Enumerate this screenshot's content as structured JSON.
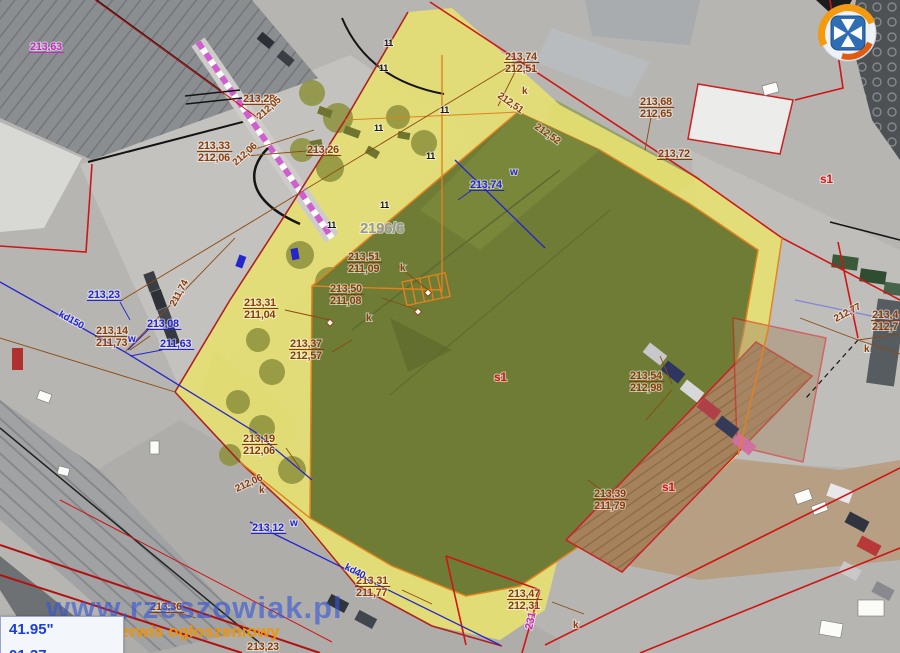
{
  "title": "aerial-cadastral-map",
  "watermark": {
    "line1": "www.rzeszowiak.pl",
    "line2": "rzeszowski serwis ogłoszeniowy"
  },
  "coords": {
    "line1": "41.95\"",
    "line2": "01.37"
  },
  "parcel_number": "2196/6",
  "colors": {
    "survey": "#8a3c08",
    "water": "#2525cf",
    "red": "#e01010",
    "magenta": "#c42ac4",
    "gray": "#97998a",
    "black": "#151515"
  },
  "map_annotations": [
    {
      "x": 505,
      "y": 60,
      "c": "survey",
      "lines": [
        "213,74",
        "212,51"
      ]
    },
    {
      "x": 640,
      "y": 105,
      "c": "survey",
      "lines": [
        "213,68",
        "212,65"
      ]
    },
    {
      "x": 348,
      "y": 260,
      "c": "survey",
      "lines": [
        "213,51",
        "211,09"
      ]
    },
    {
      "x": 330,
      "y": 292,
      "c": "survey",
      "lines": [
        "213,50",
        "211,08"
      ]
    },
    {
      "x": 244,
      "y": 306,
      "c": "survey",
      "lines": [
        "213,31",
        "211,04"
      ]
    },
    {
      "x": 290,
      "y": 347,
      "c": "survey",
      "lines": [
        "213,37",
        "212,57"
      ]
    },
    {
      "x": 96,
      "y": 334,
      "c": "survey",
      "lines": [
        "213,14",
        "211,73"
      ]
    },
    {
      "x": 243,
      "y": 442,
      "c": "survey",
      "lines": [
        "213,19",
        "212,06"
      ]
    },
    {
      "x": 356,
      "y": 584,
      "c": "survey",
      "lines": [
        "213,31",
        "211,77"
      ]
    },
    {
      "x": 508,
      "y": 597,
      "c": "survey",
      "lines": [
        "213,47",
        "212,31"
      ]
    },
    {
      "x": 594,
      "y": 497,
      "c": "survey",
      "lines": [
        "213,39",
        "211,79"
      ]
    },
    {
      "x": 630,
      "y": 379,
      "c": "survey",
      "lines": [
        "213,54",
        "212,98"
      ]
    },
    {
      "x": 198,
      "y": 149,
      "c": "survey",
      "lines": [
        "213,33",
        "212,06"
      ]
    },
    {
      "x": 872,
      "y": 318,
      "c": "survey",
      "lines": [
        "213,4",
        "212,7"
      ]
    },
    {
      "x": 243,
      "y": 102,
      "c": "survey",
      "ul": true,
      "lines": [
        "213,28"
      ]
    },
    {
      "x": 307,
      "y": 153,
      "c": "survey",
      "ul": true,
      "lines": [
        "213,26"
      ]
    },
    {
      "x": 658,
      "y": 157,
      "c": "survey",
      "ul": true,
      "lines": [
        "213,72"
      ]
    },
    {
      "x": 150,
      "y": 610,
      "c": "survey",
      "ul": true,
      "lines": [
        "213,36"
      ]
    },
    {
      "x": 247,
      "y": 650,
      "c": "survey",
      "lines": [
        "213,23"
      ]
    },
    {
      "x": 88,
      "y": 298,
      "c": "water",
      "ul": true,
      "lines": [
        "213,23"
      ]
    },
    {
      "x": 147,
      "y": 327,
      "c": "water",
      "ul": true,
      "lines": [
        "213,08"
      ]
    },
    {
      "x": 160,
      "y": 347,
      "c": "water",
      "ul": true,
      "lines": [
        "211,63"
      ]
    },
    {
      "x": 470,
      "y": 188,
      "c": "water",
      "ul": true,
      "lines": [
        "213,74"
      ]
    },
    {
      "x": 252,
      "y": 531,
      "c": "water",
      "ul": true,
      "lines": [
        "213,12"
      ]
    },
    {
      "x": 30,
      "y": 50,
      "c": "magenta",
      "ul": true,
      "lines": [
        "213,63"
      ]
    },
    {
      "x": 360,
      "y": 233,
      "c": "gray",
      "fs": 15,
      "lines": [
        "2196/6"
      ]
    },
    {
      "x": 494,
      "y": 381,
      "c": "red",
      "fs": 12,
      "lines": [
        "s1"
      ]
    },
    {
      "x": 662,
      "y": 491,
      "c": "red",
      "fs": 12,
      "lines": [
        "s1"
      ]
    },
    {
      "x": 820,
      "y": 183,
      "c": "red",
      "fs": 12,
      "lines": [
        "s1"
      ]
    },
    {
      "x": 400,
      "y": 271,
      "c": "survey",
      "fs": 10,
      "lines": [
        "k"
      ]
    },
    {
      "x": 366,
      "y": 321,
      "c": "survey",
      "fs": 10,
      "lines": [
        "k"
      ]
    },
    {
      "x": 522,
      "y": 94,
      "c": "survey",
      "fs": 10,
      "lines": [
        "k"
      ]
    },
    {
      "x": 259,
      "y": 493,
      "c": "survey",
      "fs": 10,
      "lines": [
        "k"
      ]
    },
    {
      "x": 573,
      "y": 628,
      "c": "survey",
      "fs": 10,
      "lines": [
        "k"
      ]
    },
    {
      "x": 864,
      "y": 352,
      "c": "survey",
      "fs": 10,
      "lines": [
        "k"
      ]
    },
    {
      "x": 510,
      "y": 175,
      "c": "water",
      "fs": 10,
      "lines": [
        "w"
      ]
    },
    {
      "x": 128,
      "y": 342,
      "c": "water",
      "fs": 10,
      "lines": [
        "w"
      ]
    },
    {
      "x": 290,
      "y": 526,
      "c": "water",
      "fs": 10,
      "lines": [
        "w"
      ]
    },
    {
      "x": 497,
      "y": 97,
      "c": "survey",
      "fs": 10,
      "rot": 35,
      "lines": [
        "212,51"
      ]
    },
    {
      "x": 534,
      "y": 128,
      "c": "survey",
      "fs": 10,
      "rot": 35,
      "lines": [
        "212,52"
      ]
    },
    {
      "x": 175,
      "y": 307,
      "c": "survey",
      "fs": 10,
      "rot": -62,
      "lines": [
        "211,74"
      ]
    },
    {
      "x": 260,
      "y": 120,
      "c": "survey",
      "fs": 10,
      "rot": -42,
      "lines": [
        "212,05"
      ]
    },
    {
      "x": 236,
      "y": 166,
      "c": "survey",
      "fs": 10,
      "rot": -42,
      "lines": [
        "212,06"
      ]
    },
    {
      "x": 237,
      "y": 492,
      "c": "survey",
      "fs": 10,
      "rot": -25,
      "lines": [
        "212,06"
      ]
    },
    {
      "x": 836,
      "y": 322,
      "c": "survey",
      "fs": 10,
      "rot": -28,
      "lines": [
        "212,77"
      ]
    },
    {
      "x": 344,
      "y": 569,
      "c": "water",
      "fs": 10,
      "rot": 27,
      "lines": [
        "kd40"
      ]
    },
    {
      "x": 58,
      "y": 316,
      "c": "water",
      "fs": 10,
      "rot": 29,
      "lines": [
        "kd150"
      ]
    },
    {
      "x": 532,
      "y": 630,
      "c": "magenta",
      "fs": 11,
      "rot": -78,
      "lines": [
        "231"
      ]
    },
    {
      "x": 384,
      "y": 46,
      "c": "black",
      "fs": 9,
      "lines": [
        "11"
      ]
    },
    {
      "x": 379,
      "y": 71,
      "c": "black",
      "fs": 9,
      "lines": [
        "11"
      ]
    },
    {
      "x": 440,
      "y": 113,
      "c": "black",
      "fs": 9,
      "lines": [
        "11"
      ]
    },
    {
      "x": 374,
      "y": 131,
      "c": "black",
      "fs": 9,
      "lines": [
        "11"
      ]
    },
    {
      "x": 426,
      "y": 159,
      "c": "black",
      "fs": 9,
      "lines": [
        "11"
      ]
    },
    {
      "x": 380,
      "y": 208,
      "c": "black",
      "fs": 9,
      "lines": [
        "11"
      ]
    },
    {
      "x": 327,
      "y": 228,
      "c": "black",
      "fs": 9,
      "lines": [
        "11"
      ]
    }
  ]
}
